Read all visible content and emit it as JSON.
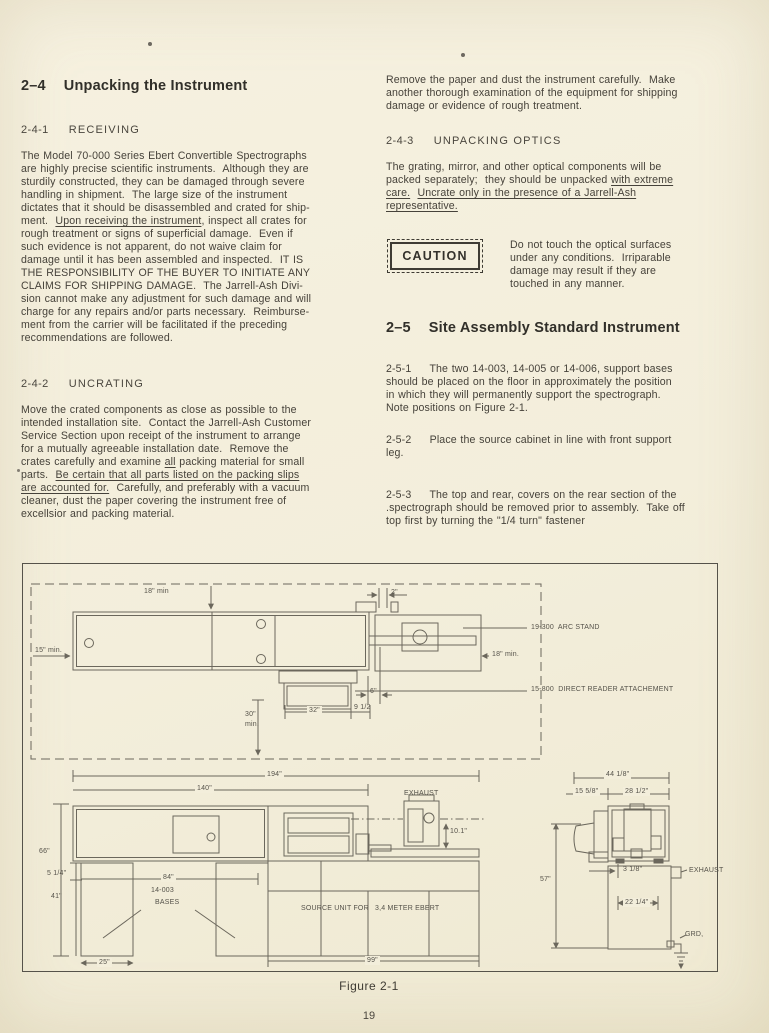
{
  "page": {
    "number": "19"
  },
  "left_column": {
    "heading": {
      "number": "2–4",
      "title": "Unpacking the Instrument"
    },
    "receiving": {
      "number": "2-4-1",
      "title": "RECEIVING",
      "lines": [
        "The Model 70-000 Series Ebert Convertible Spectrographs",
        "are highly precise scientific instruments.  Although they are",
        "sturdily constructed, they can be damaged through severe",
        "handling in shipment.  The large size of the instrument",
        "dictates that it should be disassembled and crated for ship-",
        [
          {
            "t": "ment.  "
          },
          {
            "t": "Upon receiving the instrument",
            "u": true
          },
          {
            "t": ", inspect all crates for"
          }
        ],
        "rough treatment or signs of superficial damage.  Even if",
        "such evidence is not apparent, do not waive claim for",
        "damage until it has been assembled and inspected.  IT IS",
        "THE RESPONSIBILITY OF THE BUYER TO INITIATE ANY",
        "CLAIMS FOR SHIPPING DAMAGE.  The Jarrell-Ash Divi-",
        "sion cannot make any adjustment for such damage and will",
        "charge for any repairs and/or parts necessary.  Reimburse-",
        "ment from the carrier will be facilitated if the preceding",
        "recommendations are followed."
      ]
    },
    "uncrating": {
      "number": "2-4-2",
      "title": "UNCRATING",
      "lines": [
        "Move the crated components as close as possible to the",
        "intended installation site.  Contact the Jarrell-Ash Customer",
        "Service Section upon receipt of the instrument to arrange",
        "for a mutually agreeable installation date.  Remove the",
        [
          {
            "t": "crates carefully and examine "
          },
          {
            "t": "all",
            "u": true
          },
          {
            "t": " packing material for small"
          }
        ],
        [
          {
            "t": "parts.  "
          },
          {
            "t": "Be certain that all parts listed on the packing slips",
            "u": true
          }
        ],
        [
          {
            "t": "are accounted for.",
            "u": true
          },
          {
            "t": "  Carefully, and preferably with a vacuum"
          }
        ],
        "cleaner, dust the paper covering the instrument free of",
        "excellsior and packing material."
      ]
    }
  },
  "right_column": {
    "intro_lines": [
      "Remove the paper and dust the instrument carefully.  Make",
      "another thorough examination of the equipment for shipping",
      "damage or evidence of rough treatment."
    ],
    "unpacking_optics": {
      "number": "2-4-3",
      "title": "UNPACKING OPTICS",
      "lines": [
        "The grating, mirror, and other optical components will be",
        [
          {
            "t": "packed separately;  they should be unpacked "
          },
          {
            "t": "with extreme",
            "u": true
          }
        ],
        [
          {
            "t": "care.",
            "u": true
          },
          {
            "t": "  "
          },
          {
            "t": "Uncrate only in the presence of a Jarrell-Ash",
            "u": true
          }
        ],
        [
          {
            "t": "representative.",
            "u": true
          }
        ]
      ]
    },
    "caution": {
      "box_label": "CAUTION",
      "lines": [
        "Do not touch the optical surfaces",
        "under any conditions.  Irriparable",
        "damage may result if they are",
        "touched in any manner."
      ]
    },
    "site_assembly": {
      "heading": {
        "number": "2–5",
        "title": "Site Assembly Standard Instrument"
      },
      "paragraphs": [
        {
          "lines": [
            "2-5-1     The two 14-003, 14-005 or 14-006, support bases",
            "should be placed on the floor in approximately the position",
            "in which they will permanently support the spectrograph.",
            "Note positions on Figure 2-1."
          ]
        },
        {
          "lines": [
            "2-5-2     Place the source cabinet in line with front support",
            "leg."
          ]
        },
        {
          "lines": [
            "2-5-3     The top and rear, covers on the rear section of the",
            ".spectrograph should be removed prior to assembly.  Take off",
            "top first by turning the \"1/4 turn\" fastener"
          ]
        }
      ]
    }
  },
  "figure": {
    "caption": "Figure 2-1",
    "labels": [
      {
        "text": "18\" min",
        "x": 121,
        "y": 23,
        "name": "dim-18in-min-top"
      },
      {
        "text": "2\"",
        "x": 368,
        "y": 24,
        "name": "dim-2in"
      },
      {
        "text": "15\" min.",
        "x": 12,
        "y": 82,
        "name": "dim-15in-min"
      },
      {
        "text": "18\" min.",
        "x": 469,
        "y": 86,
        "name": "dim-18in-min-right"
      },
      {
        "text": "19-300  ARC STAND",
        "x": 508,
        "y": 59,
        "name": "part-arc-stand"
      },
      {
        "text": "15-800  DIRECT READER ATTACHEMENT",
        "x": 508,
        "y": 121,
        "name": "part-direct-reader"
      },
      {
        "text": "6\"",
        "x": 347,
        "y": 123,
        "name": "dim-6in"
      },
      {
        "text": "32\"",
        "x": 284,
        "y": 142,
        "bg": true,
        "name": "dim-32in"
      },
      {
        "text": "9 1/2",
        "x": 331,
        "y": 139,
        "name": "dim-9-1-2"
      },
      {
        "text": "30\"",
        "x": 222,
        "y": 146,
        "name": "dim-30in"
      },
      {
        "text": "min.",
        "x": 222,
        "y": 156,
        "name": "dim-30in-min"
      },
      {
        "text": "194\"",
        "x": 242,
        "y": 206,
        "bg": true,
        "name": "dim-194in"
      },
      {
        "text": "140\"",
        "x": 172,
        "y": 220,
        "bg": true,
        "name": "dim-140in"
      },
      {
        "text": "66\"",
        "x": 16,
        "y": 283,
        "name": "dim-66in"
      },
      {
        "text": "5 1/4\"",
        "x": 24,
        "y": 305,
        "name": "dim-5-1-4in"
      },
      {
        "text": "41\"",
        "x": 28,
        "y": 328,
        "name": "dim-41in"
      },
      {
        "text": "84\"",
        "x": 138,
        "y": 309,
        "bg": true,
        "name": "dim-84in"
      },
      {
        "text": "14-003",
        "x": 128,
        "y": 322,
        "name": "part-14-003"
      },
      {
        "text": "BASES",
        "x": 132,
        "y": 334,
        "name": "part-bases"
      },
      {
        "text": "25\"",
        "x": 74,
        "y": 394,
        "bg": true,
        "name": "dim-25in"
      },
      {
        "text": "99\"",
        "x": 342,
        "y": 392,
        "bg": true,
        "name": "dim-99in"
      },
      {
        "text": "SOURCE UNIT FOR",
        "x": 278,
        "y": 340,
        "name": "part-source-unit"
      },
      {
        "text": "3,4 METER EBERT",
        "x": 352,
        "y": 340,
        "name": "part-source-unit-2"
      },
      {
        "text": "EXHAUST",
        "x": 381,
        "y": 225,
        "name": "part-exhaust-top"
      },
      {
        "text": "10.1\"",
        "x": 427,
        "y": 263,
        "name": "dim-10-1in"
      },
      {
        "text": "57\"",
        "x": 517,
        "y": 311,
        "name": "dim-57in"
      },
      {
        "text": "44 1/8\"",
        "x": 581,
        "y": 206,
        "bg": true,
        "name": "dim-44-1-8in"
      },
      {
        "text": "15 5/8\"",
        "x": 550,
        "y": 223,
        "bg": true,
        "name": "dim-15-5-8in"
      },
      {
        "text": "28 1/2\"",
        "x": 600,
        "y": 223,
        "bg": true,
        "name": "dim-28-1-2in"
      },
      {
        "text": "3 1/8\"",
        "x": 600,
        "y": 301,
        "name": "dim-3-1-8in"
      },
      {
        "text": "22 1/4\"",
        "x": 600,
        "y": 334,
        "bg": true,
        "name": "dim-22-1-4in"
      },
      {
        "text": "EXHAUST",
        "x": 666,
        "y": 302,
        "name": "part-exhaust-side"
      },
      {
        "text": "GRD,",
        "x": 662,
        "y": 366,
        "name": "part-ground"
      }
    ]
  }
}
